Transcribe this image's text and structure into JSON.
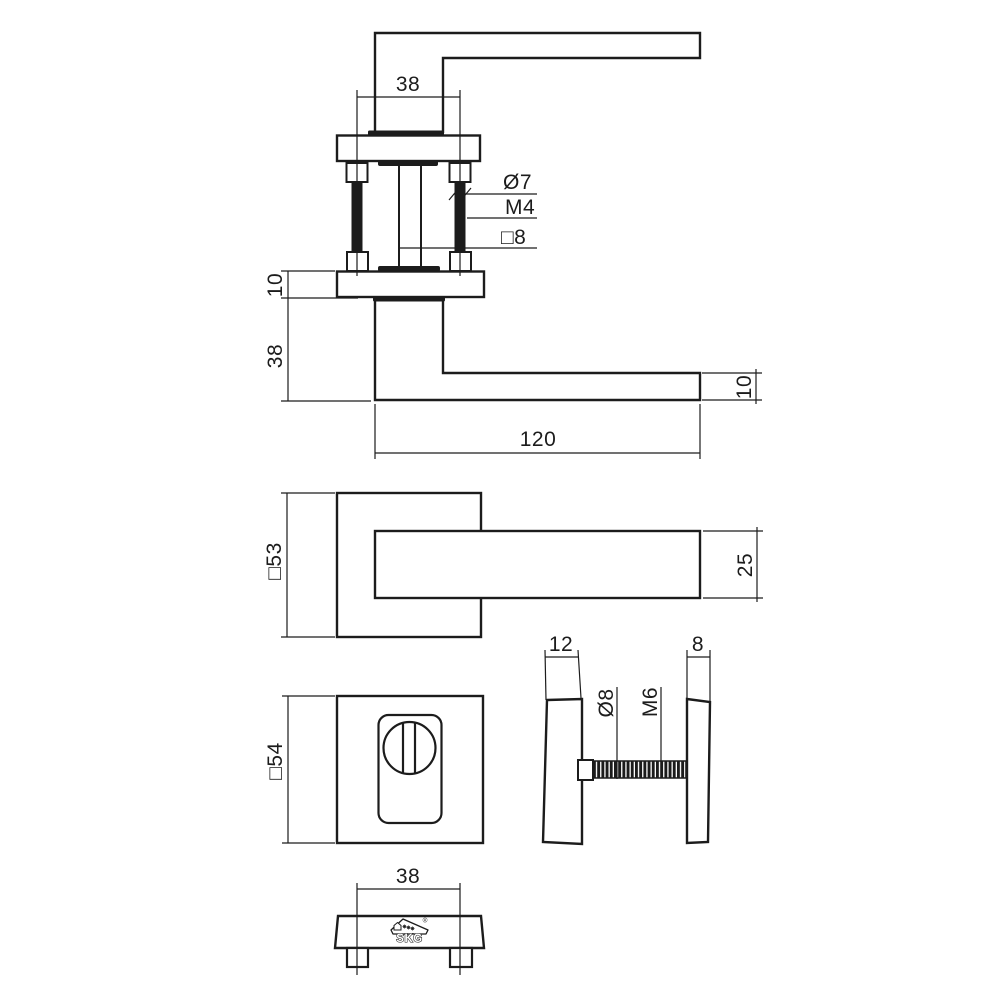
{
  "colors": {
    "background": "#ffffff",
    "line": "#1c1c1c"
  },
  "views": {
    "handle_section": {
      "dim_screw_spacing": "38",
      "label_screw_diameter": "Ø7",
      "label_screw_thread": "M4",
      "label_spindle_square": "□8",
      "dim_rosette_thickness": "10",
      "dim_handle_drop": "38",
      "dim_lever_length": "120",
      "dim_lever_thickness": "10"
    },
    "handle_front": {
      "dim_rosette_square": "□53",
      "dim_lever_section": "25"
    },
    "security_rosette_front": {
      "dim_rosette_square": "□54"
    },
    "security_rosette_side": {
      "dim_outer_rosette_thickness": "12",
      "dim_inner_rosette_thickness": "8",
      "label_bolt_diameter": "Ø8",
      "label_bolt_thread": "M6"
    },
    "rosette_bottom": {
      "dim_screw_spacing": "38",
      "logo_text": "SKG",
      "logo_registered": "®"
    }
  }
}
